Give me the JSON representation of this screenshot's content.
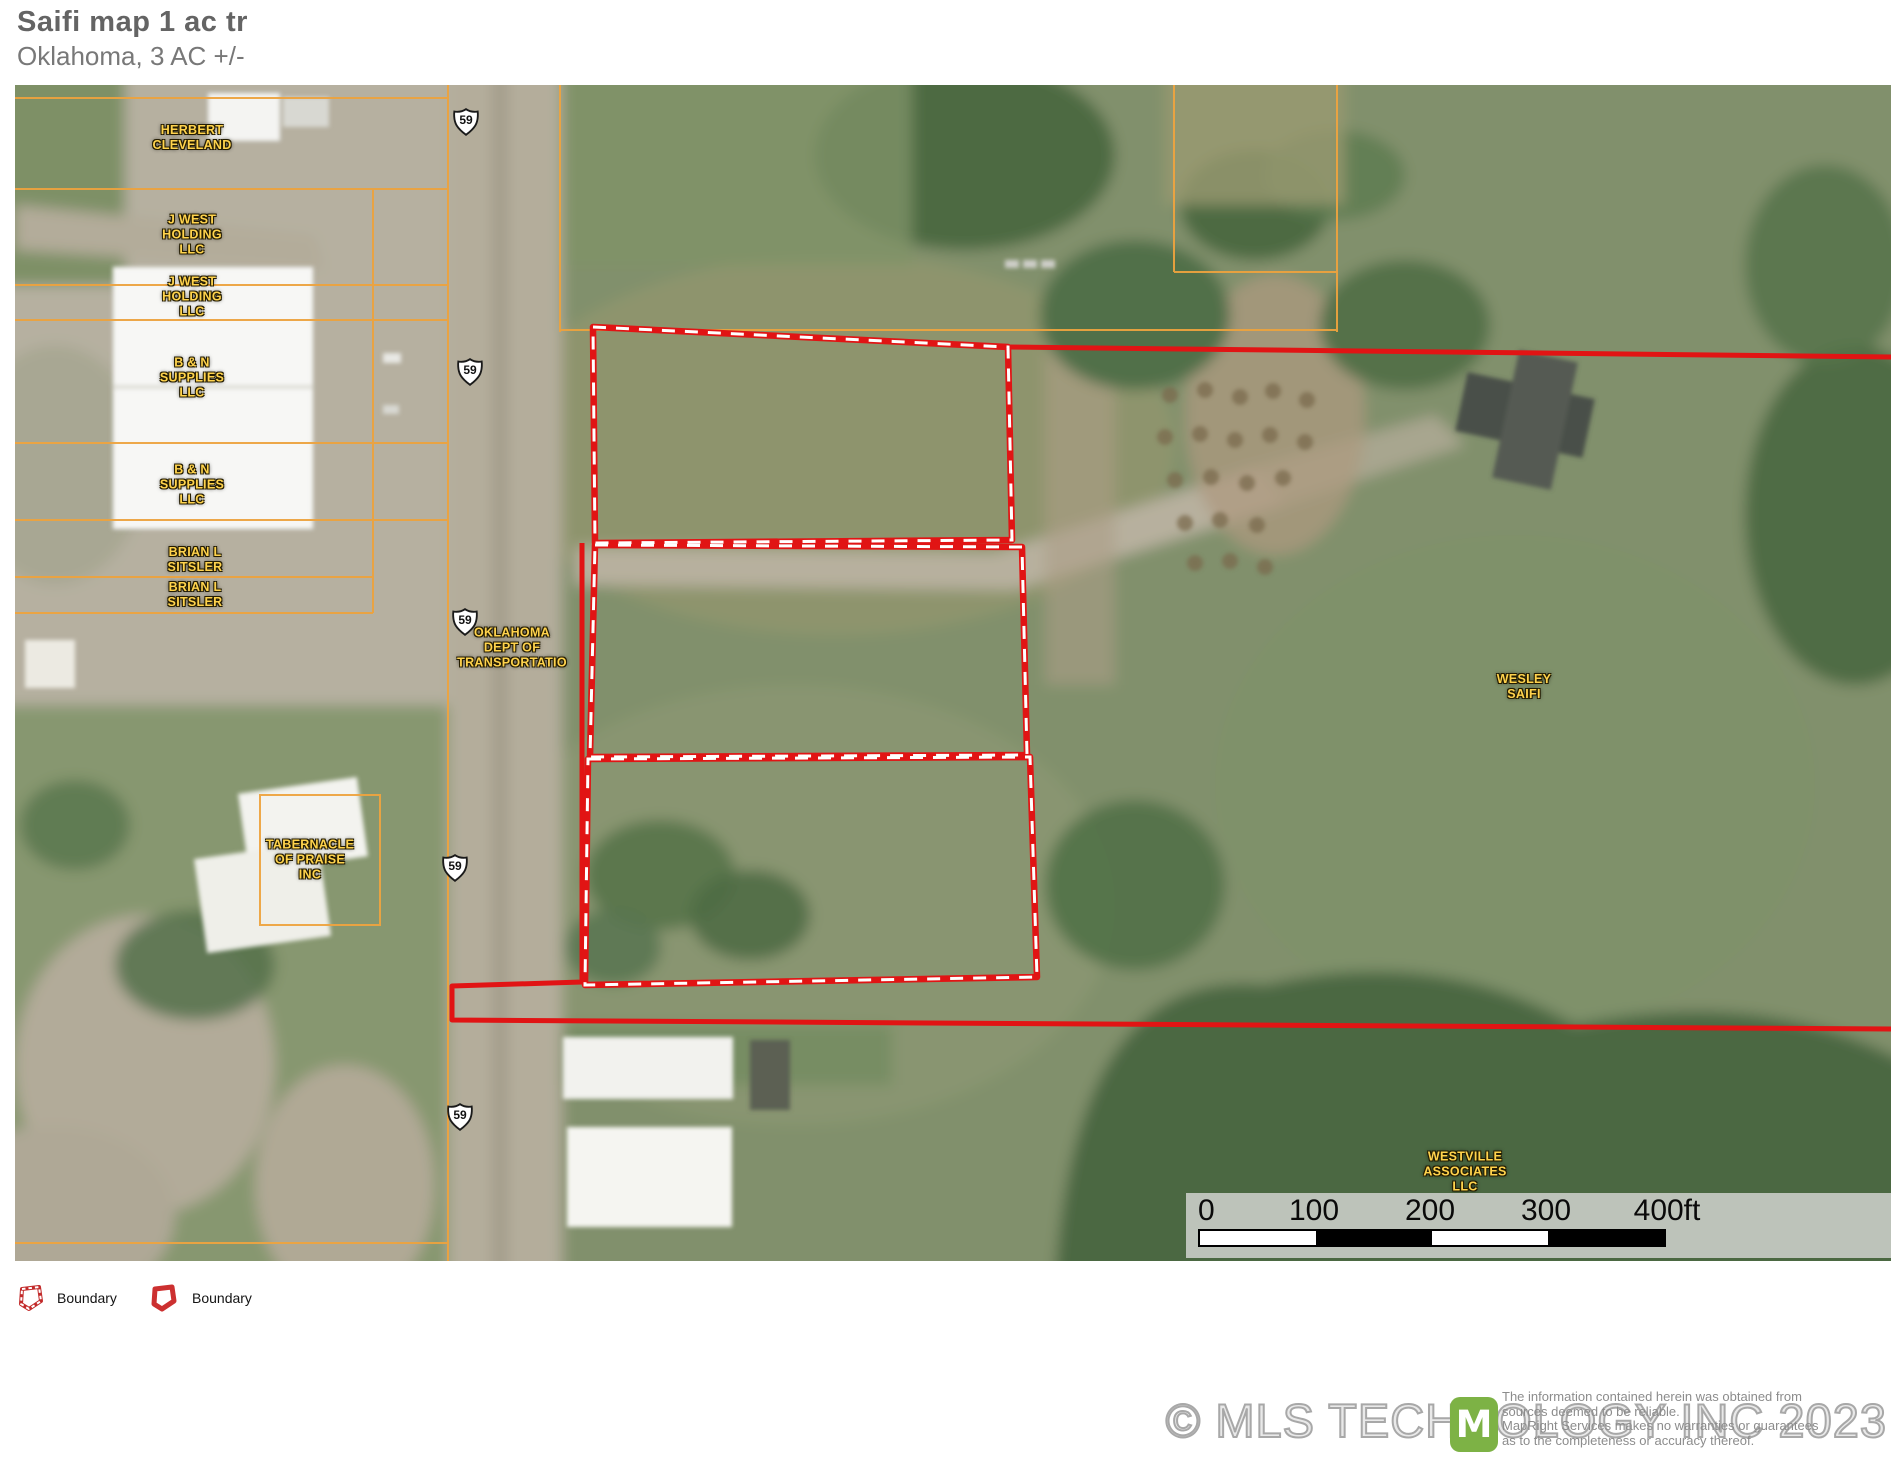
{
  "header": {
    "title": "Saifi map 1 ac tr",
    "subtitle": "Oklahoma, 3 AC +/-"
  },
  "map": {
    "parcel_labels": [
      {
        "name": "herbert-cleveland",
        "text": "HERBERT\nCLEVELAND"
      },
      {
        "name": "j-west-holding-llc-1",
        "text": "J WEST\nHOLDING\nLLC"
      },
      {
        "name": "j-west-holding-llc-2",
        "text": "J WEST\nHOLDING\nLLC"
      },
      {
        "name": "b-n-supplies-llc-1",
        "text": "B & N\nSUPPLIES\nLLC"
      },
      {
        "name": "b-n-supplies-llc-2",
        "text": "B & N\nSUPPLIES\nLLC"
      },
      {
        "name": "brian-l-sitsler-1",
        "text": "BRIAN L\nSITSLER"
      },
      {
        "name": "brian-l-sitsler-2",
        "text": "BRIAN L\nSITSLER"
      },
      {
        "name": "oklahoma-dept-of-transportatio",
        "text": "OKLAHOMA\nDEPT OF\nTRANSPORTATIO"
      },
      {
        "name": "tabernacle-of-praise-inc",
        "text": "TABERNACLE\nOF PRAISE\nINC"
      },
      {
        "name": "wesley-saifi",
        "text": "WESLEY\nSAIFI"
      },
      {
        "name": "westville-associates-llc",
        "text": "WESTVILLE\nASSOCIATES\nLLC"
      }
    ],
    "highway_shield": {
      "route": "59"
    },
    "scale_bar": {
      "ticks": [
        "0",
        "100",
        "200",
        "300",
        "400ft"
      ]
    }
  },
  "legend": {
    "items": [
      {
        "label": "Boundary",
        "style": "dashed"
      },
      {
        "label": "Boundary",
        "style": "solid"
      }
    ]
  },
  "footer": {
    "copyright": "© MLS TECHNOLOGY INC 2023",
    "logo_letter": "M",
    "disclaimer_lines": [
      "The information contained herein was obtained from",
      "sources deemed to be reliable.",
      "MapRight Services makes no warranties or guarantees",
      "as to the completeness or accuracy thereof."
    ]
  },
  "colors": {
    "boundary_red": "#e11414",
    "parcel_line_orange": "#eda33f",
    "label_yellow": "#ffd34d",
    "logo_green": "#7db245"
  }
}
